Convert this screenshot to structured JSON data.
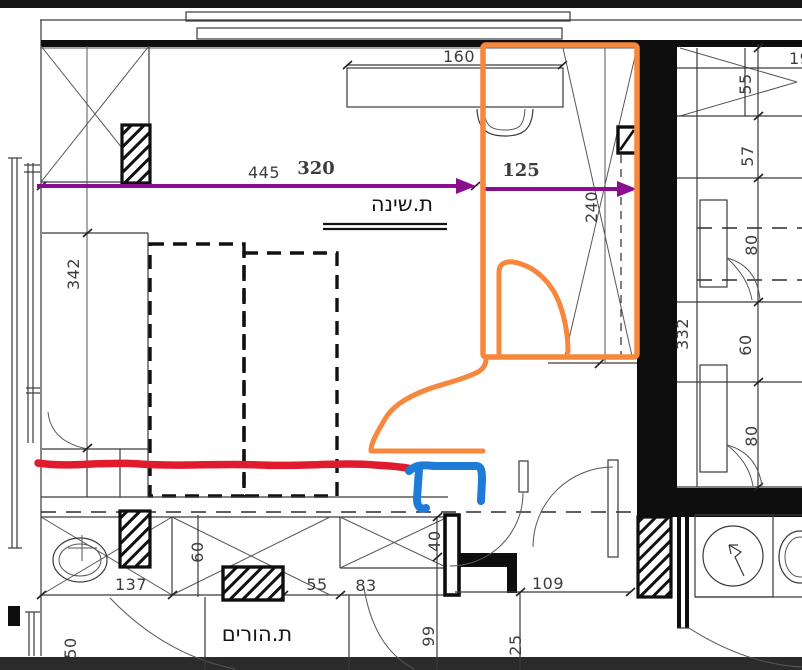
{
  "rooms": {
    "bedroom": "ת.שינה",
    "parents": "ת.הורים"
  },
  "dims": {
    "d445": "445",
    "d160": "160",
    "d342": "342",
    "d240": "240",
    "d19": "19",
    "r55": "55",
    "r57": "57",
    "r80a": "80",
    "r332": "332",
    "r60": "60",
    "r80b": "80",
    "b137": "137",
    "b60": "60",
    "b55": "55",
    "b83": "83",
    "b40": "40",
    "b109": "109",
    "b99": "99",
    "b25": "25",
    "b50": "50"
  },
  "annotations": {
    "purple_left": "320",
    "purple_right": "125"
  },
  "colors": {
    "purple": "#8A0F8E",
    "orange": "#F6873C",
    "red": "#E11B2E",
    "blue": "#1E7BD8",
    "ink": "#141414",
    "dim_text": "#3d3d3d"
  }
}
